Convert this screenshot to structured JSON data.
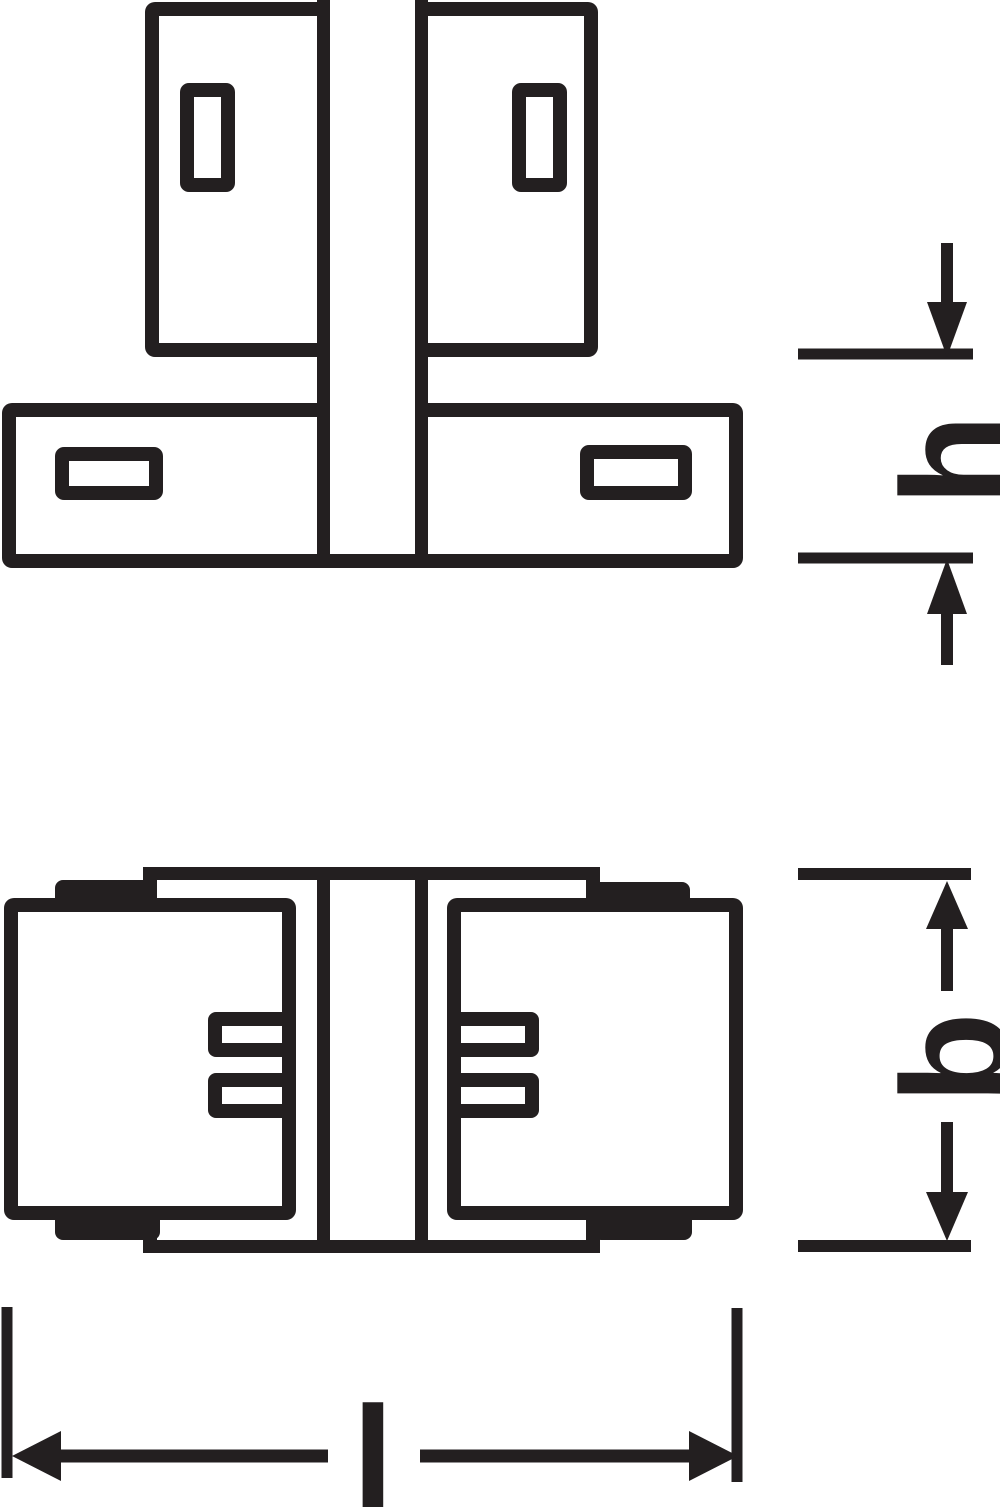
{
  "drawing": {
    "ink_color": "#231f20",
    "background_color": "#ffffff",
    "dimension_labels": {
      "height": "h",
      "width": "b",
      "length": "l"
    }
  }
}
